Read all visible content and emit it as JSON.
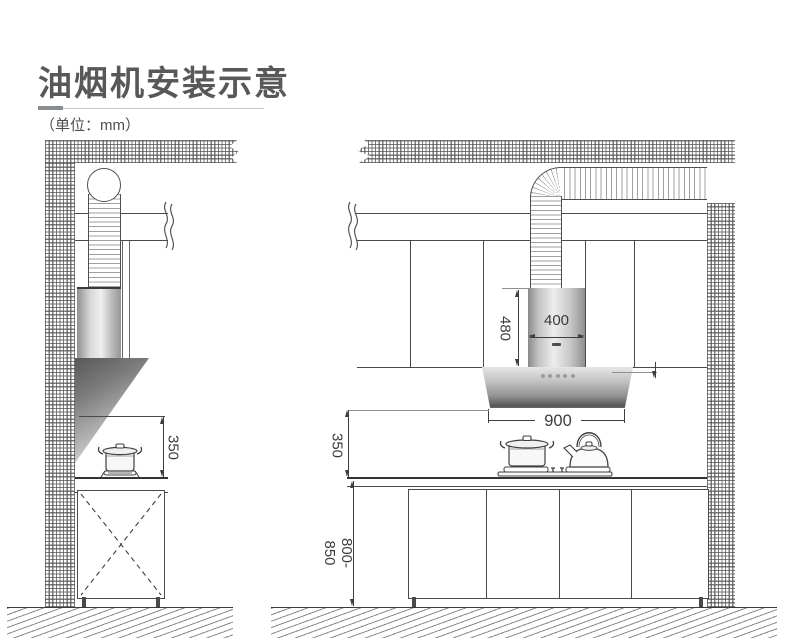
{
  "header": {
    "title": "油烟机安装示意",
    "unit_note": "（单位：mm）"
  },
  "left_view": {
    "dim_hood_to_counter": "350"
  },
  "right_view": {
    "dim_chimney_height": "480",
    "dim_chimney_width": "400",
    "dim_hood_width": "900",
    "dim_hood_to_counter": "350",
    "dim_counter_height": "800-850"
  },
  "colors": {
    "title_text": "#57585a",
    "line": "#4a4a4a",
    "dim_text": "#3c3c3c",
    "hood_dark": "#555555",
    "hood_light": "#e6e6e6",
    "hatch": "#8a8a8a"
  }
}
